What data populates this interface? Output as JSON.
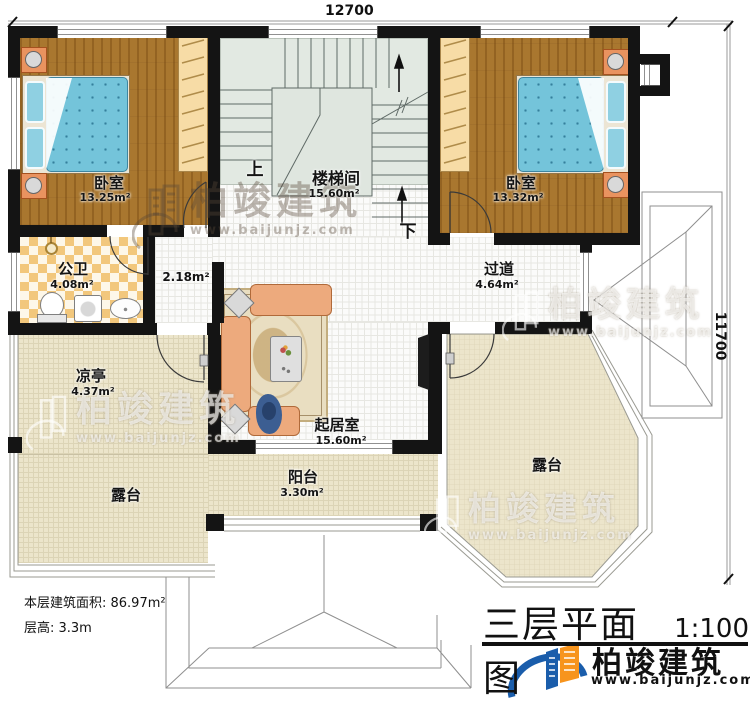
{
  "dimensions": {
    "width_mm": "12700",
    "height_mm": "11700"
  },
  "rooms": {
    "bedroom_left": {
      "name": "卧室",
      "area": "13.25m²"
    },
    "stairwell": {
      "name": "楼梯间",
      "area": "15.60m²"
    },
    "bedroom_right": {
      "name": "卧室",
      "area": "13.32m²"
    },
    "bathroom": {
      "name": "公卫",
      "area": "4.08m²"
    },
    "hall_nook": {
      "area": "2.18m²"
    },
    "corridor": {
      "name": "过道",
      "area": "4.64m²"
    },
    "pavilion": {
      "name": "凉亭",
      "area": "4.37m²"
    },
    "living_room": {
      "name": "起居室",
      "area": "15.60m²"
    },
    "balcony": {
      "name": "阳台",
      "area": "3.30m²"
    },
    "terrace_left": {
      "name": "露台"
    },
    "terrace_right": {
      "name": "露台"
    }
  },
  "stairs": {
    "up": "上",
    "down": "下"
  },
  "notes": {
    "floor_area": "本层建筑面积: 86.97m²",
    "floor_height": "层高: 3.3m"
  },
  "title_block": {
    "title": "三层平面图",
    "scale": "1:100",
    "brand": "柏竣建筑",
    "website": "www.baijunjz.com"
  },
  "watermark": {
    "text": "柏竣建筑",
    "url": "www.baijunjz.com"
  },
  "colors": {
    "wall": "#141414",
    "wood_floor": "#a9772f",
    "mattress_blue": "#74c4da",
    "terrace_tan": "#ece5cb",
    "stair_floor": "#e2e9e2",
    "bath_checker": "#f2c77c",
    "sofa_orange": "#edaa7d",
    "rug_beige": "#e9dec1",
    "logo_blue": "#1a5dab",
    "logo_orange": "#f7941d"
  }
}
